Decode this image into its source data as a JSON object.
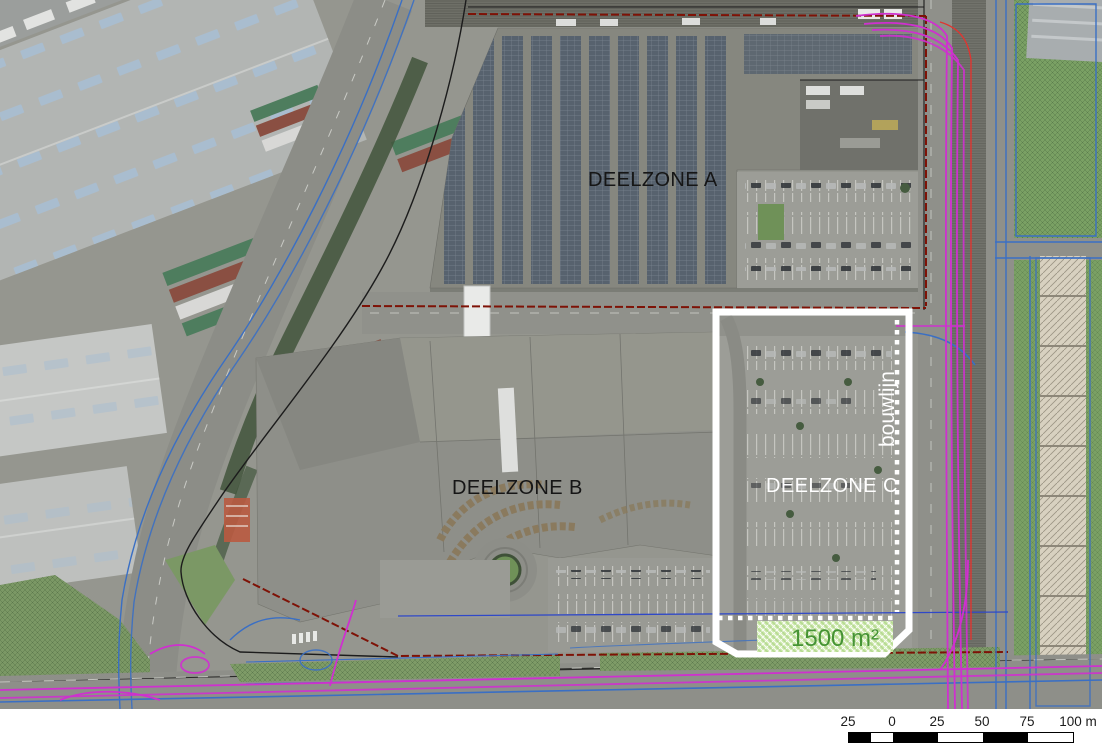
{
  "map": {
    "description": "Aerial development plan with three sub-zones",
    "zones": [
      {
        "label": "DEELZONE A",
        "text_color": "#161616"
      },
      {
        "label": "DEELZONE B",
        "text_color": "#161616"
      },
      {
        "label": "DEELZONE C",
        "text_color": "#ffffff"
      }
    ],
    "zone_c_overlay": {
      "outline_color": "#ffffff",
      "build_line_label": "bouwlijn",
      "build_line_style": "dotted-white",
      "reserved_area_label": "1500 m²",
      "reserved_area_fill": "#c9e6a7",
      "reserved_area_text_color": "#459334"
    },
    "line_colors": {
      "site_boundary_red": "#7e1206",
      "parcel_boundary_black": "#1c1c1c",
      "utilities_blue": "#3a6fc4",
      "utilities_magenta": "#cf30cf"
    }
  },
  "scalebar": {
    "tick_labels": [
      "25",
      "0",
      "25",
      "50",
      "75",
      "100 m"
    ],
    "total_meters": 125,
    "segments_meters": [
      12.5,
      12.5,
      25,
      25,
      25,
      25
    ],
    "segment_colors": [
      "#000000",
      "#ffffff",
      "#000000",
      "#ffffff",
      "#000000",
      "#ffffff"
    ]
  }
}
